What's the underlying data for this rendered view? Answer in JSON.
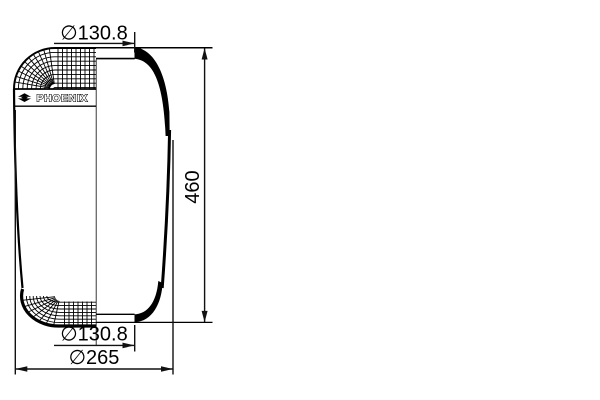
{
  "drawing": {
    "type": "technical-drawing-air-spring-bellows",
    "brand": "PHOENIX",
    "dimensions": {
      "top_diameter": "∅130.8",
      "bottom_diameter": "∅130.8",
      "height": "460",
      "outer_diameter": "∅265"
    },
    "colors": {
      "line": "#000000",
      "dimension_line": "#111111",
      "background": "#ffffff"
    }
  }
}
